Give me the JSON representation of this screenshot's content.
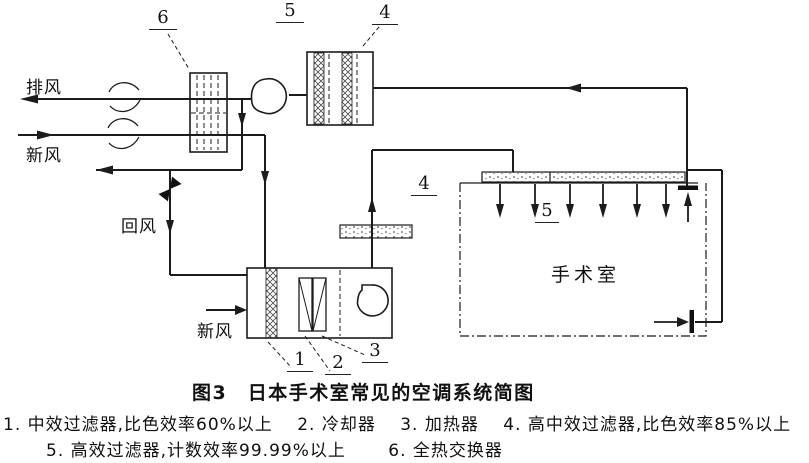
{
  "diagram": {
    "labels": {
      "exhaust_air": "排风",
      "fresh_air_top": "新风",
      "return_air": "回风",
      "fresh_air_ahu": "新风",
      "operating_room": "手术室"
    },
    "callouts": {
      "c1": "1",
      "c2": "2",
      "c3": "3",
      "c4_exhaust": "4",
      "c4_supply": "4",
      "c5_top": "5",
      "c5_ceiling": "5",
      "c6": "6"
    },
    "colors": {
      "line": "#1c1c1c",
      "background": "#ffffff"
    }
  },
  "caption": {
    "title": "图3　日本手术室常见的空调系统简图",
    "line1": "1. 中效过滤器,比色效率60%以上　 2. 冷却器　 3. 加热器　 4. 高中效过滤器,比色效率85%以上",
    "line2": "5. 高效过滤器,计数效率99.99%以上　　 6. 全热交换器"
  }
}
